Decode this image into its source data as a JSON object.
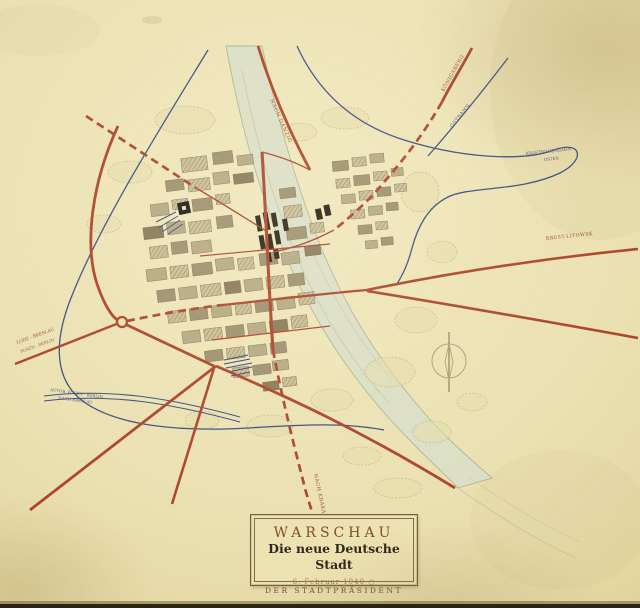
{
  "colors": {
    "paper": "#eadfae",
    "road_red": "#a83e24",
    "rail_blue": "#35487e",
    "river": "#dadec6",
    "ink_black": "#20190e"
  },
  "cartouche": {
    "city": "WARSCHAU",
    "subtitle": "Die neue Deutsche Stadt",
    "date": "6. Februar 1940",
    "date_mark": "○",
    "signature": "DER STADTPRÄSIDENT"
  },
  "labels": {
    "danzig": "NACH DANZIG",
    "koenigsberg": "KÖNIGSBERG",
    "ostbahn": "OSTBAHN",
    "kraftwagen_1": "KRAFTWAGENBAHN",
    "kraftwagen_2": "OSTEN",
    "brest": "BREST-LITOWSK",
    "lodz": "LODZ - BRESLAU",
    "posen_berlin": "POSEN - BERLIN",
    "autobahn": "AUTOB. POSEN - BERLIN",
    "breslau": "NACH BRESLAU",
    "krakau": "NACH KRAKAU"
  }
}
